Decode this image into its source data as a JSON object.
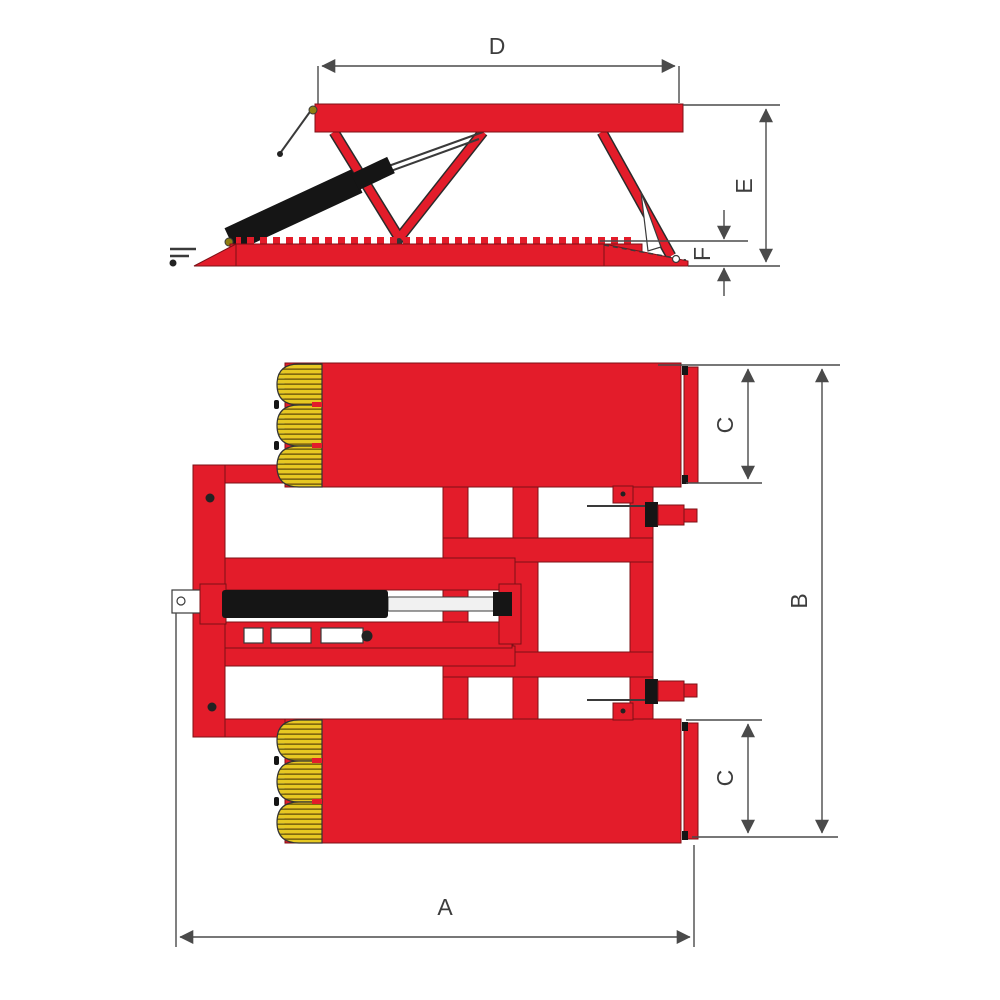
{
  "diagram": {
    "labels": {
      "top_platform_width": "D",
      "raised_height": "E",
      "base_height": "F",
      "overall_width": "A",
      "overall_length": "B",
      "platform_width_top": "C",
      "platform_width_bottom": "C"
    },
    "colors": {
      "red": "#e31c2a",
      "yellow": "#e6c822",
      "yellow_dark": "#7d6c0e",
      "black": "#151515",
      "dim_line": "#4a4a4a",
      "background": "#ffffff"
    }
  }
}
